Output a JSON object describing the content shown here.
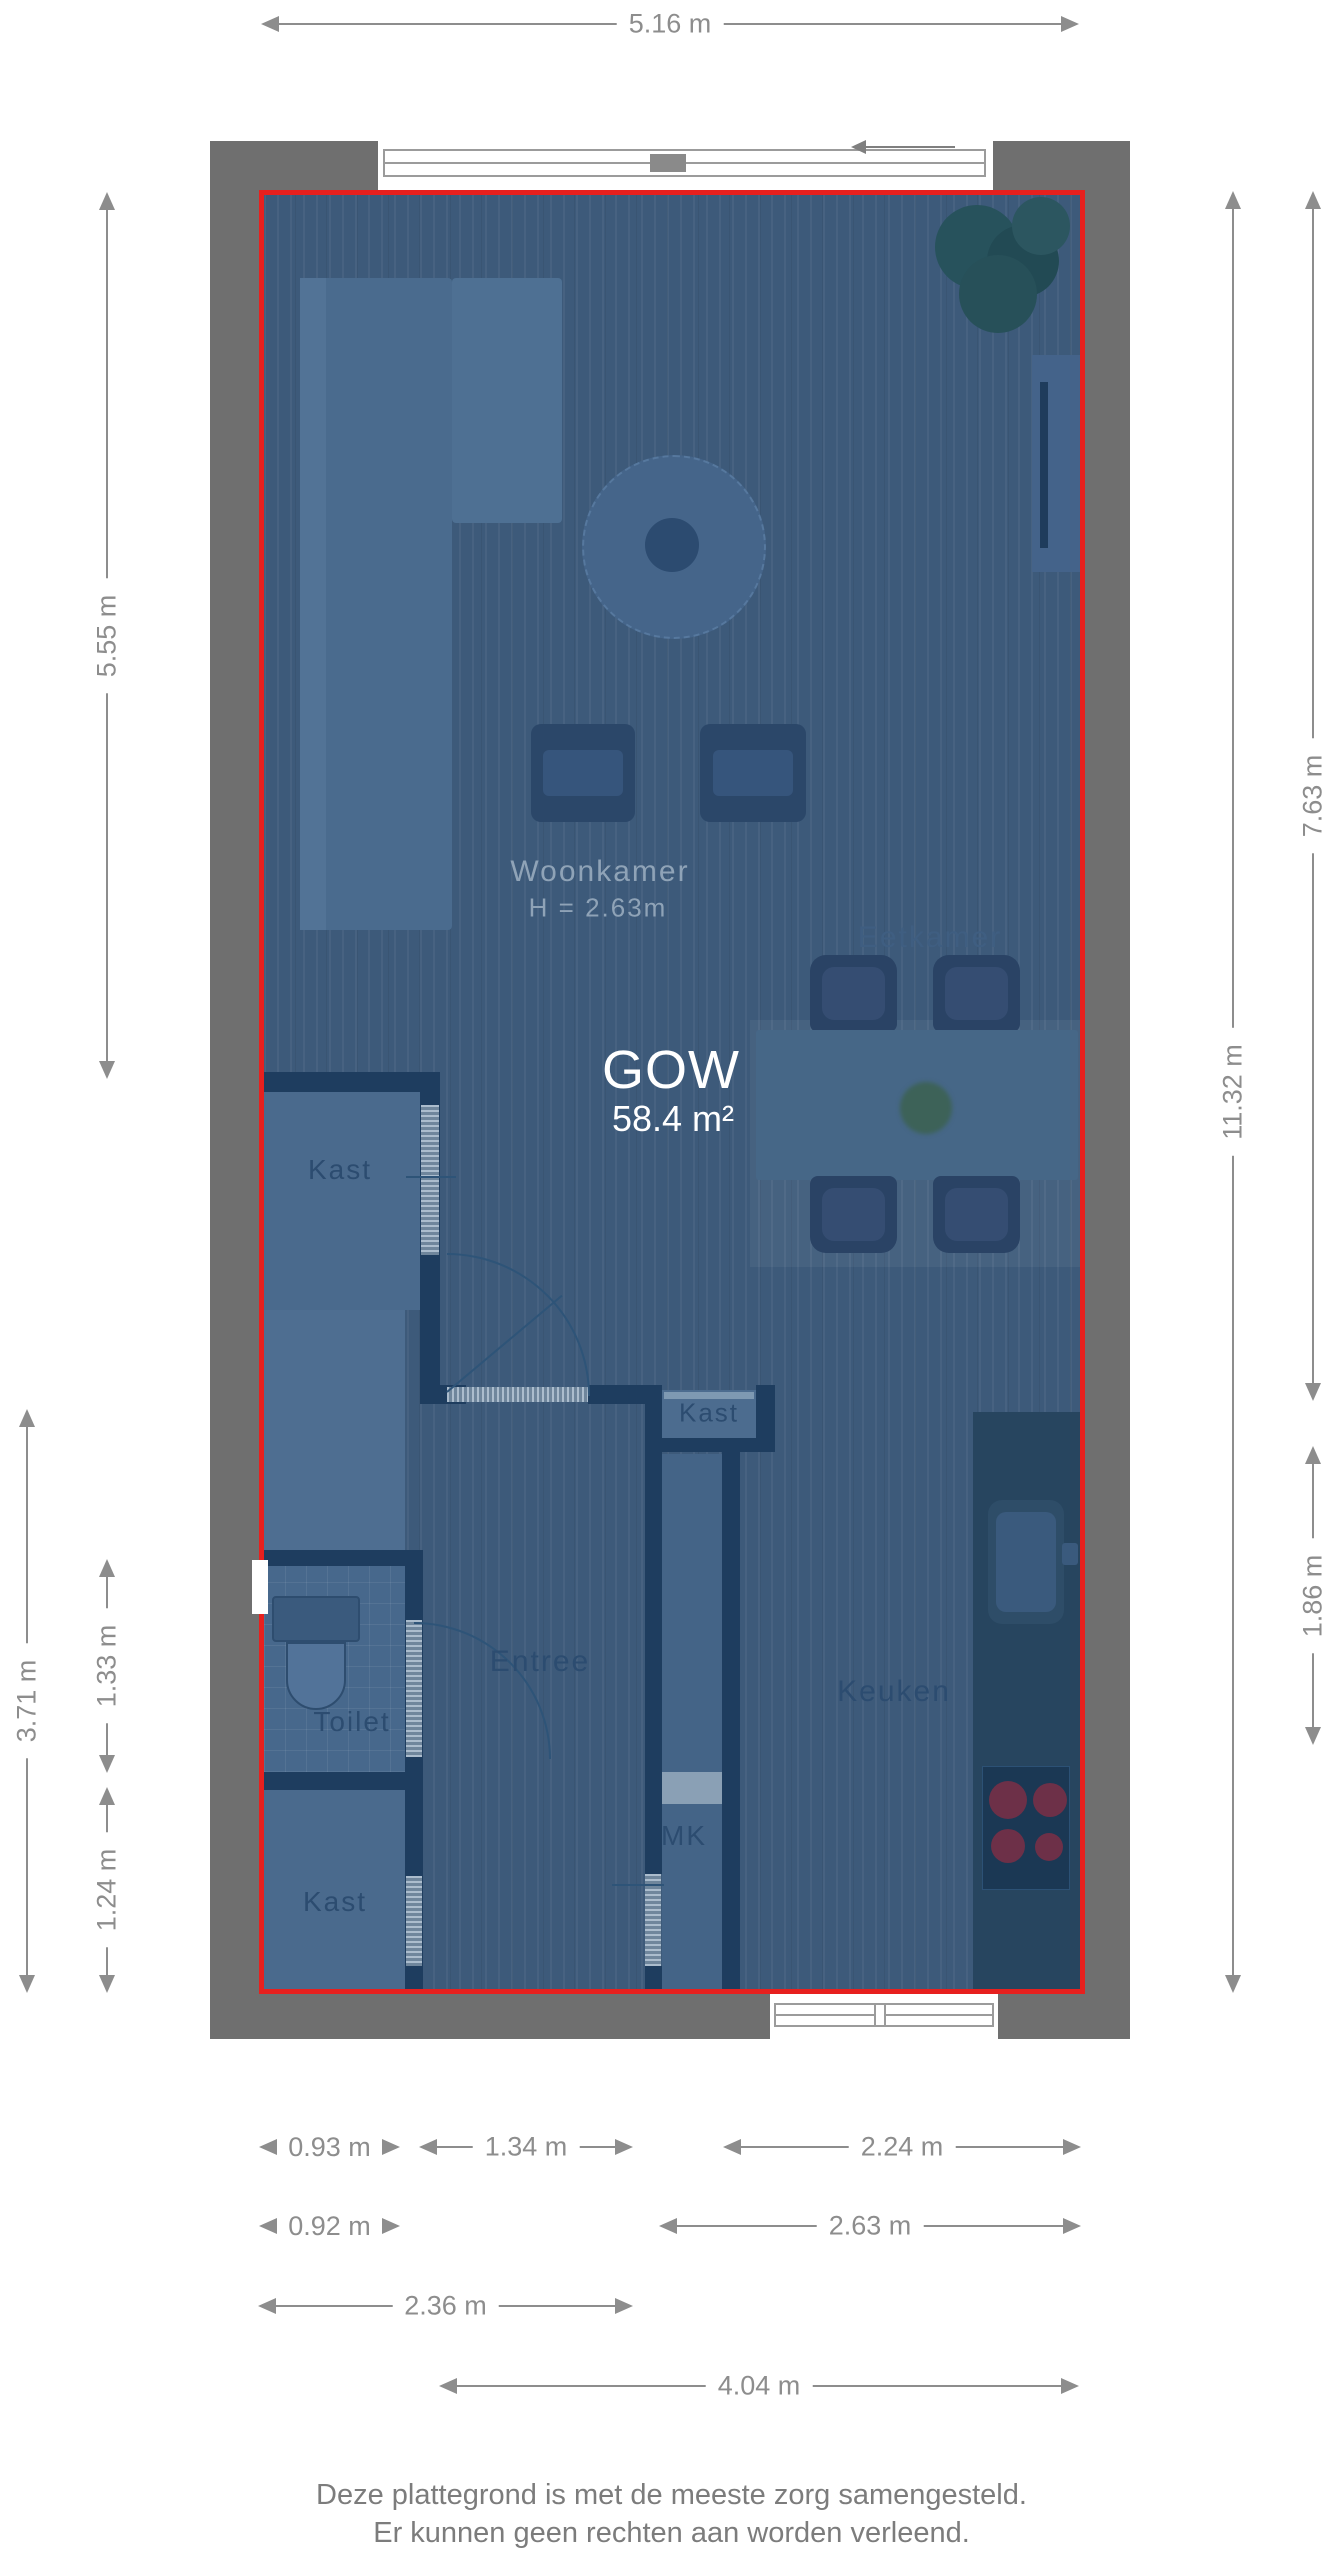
{
  "plan": {
    "gow_label": "GOW",
    "gow_area": "58.4 m²",
    "labels": {
      "woonkamer": "Woonkamer",
      "ceiling_height": "H = 2.63m",
      "eetkamer": "Eetkamer",
      "keuken": "Keuken",
      "entree": "Entree",
      "toilet": "Toilet",
      "kast_upper": "Kast",
      "kast_middle": "Kast",
      "kast_lower": "Kast",
      "meterkast": "MK"
    }
  },
  "dimensions": {
    "top": "5.16 m",
    "left": [
      "5.55 m",
      "3.71 m",
      "1.33 m",
      "1.24 m"
    ],
    "right": [
      "11.32 m",
      "7.63 m",
      "1.86 m"
    ],
    "bottom_row1": [
      "0.93 m",
      "1.34 m",
      "2.24 m"
    ],
    "bottom_row2": [
      "0.92 m",
      "2.63 m"
    ],
    "bottom_row3": [
      "2.36 m"
    ],
    "bottom_row4": [
      "4.04 m"
    ]
  },
  "footer": {
    "line1": "Deze plattegrond is met de meeste zorg samengesteld.",
    "line2": "Er kunnen geen rechten aan worden verleend."
  },
  "colors": {
    "highlight_border": "#e7201e",
    "floor_overlay": "#3d5a7a",
    "outer_wall": "#6f6f6f",
    "interior_wall": "#1e3d5f",
    "dimension_text": "#8d8d8d",
    "footer_text": "#7c7c7c"
  }
}
